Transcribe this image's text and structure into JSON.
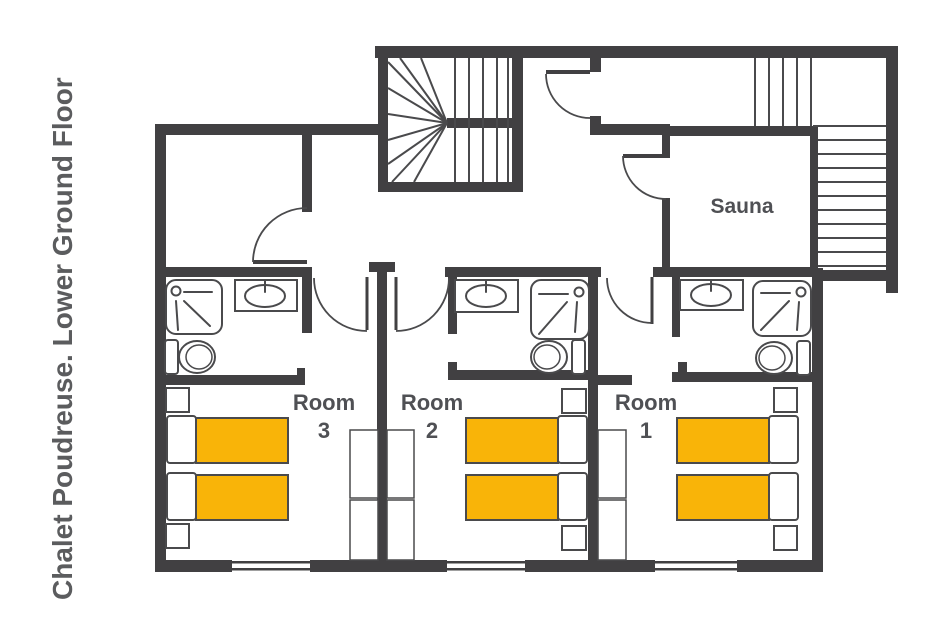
{
  "title": "Chalet Poudreuse. Lower Ground Floor",
  "sauna": {
    "label": "Sauna"
  },
  "rooms": [
    {
      "label": "Room",
      "number": "1",
      "beds": 2
    },
    {
      "label": "Room",
      "number": "2",
      "beds": 2
    },
    {
      "label": "Room",
      "number": "3",
      "beds": 2
    }
  ],
  "colors": {
    "wall": "#414042",
    "outline": "#4A4A4C",
    "bed": "#F9B408",
    "text": "#4F5054",
    "title": "#5B5C5E"
  }
}
